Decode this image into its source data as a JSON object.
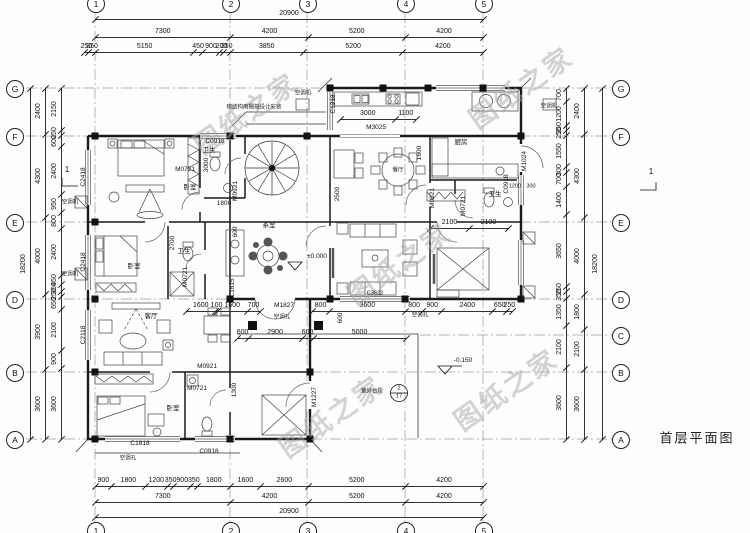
{
  "sheet": {
    "title": "首层平面图",
    "watermark": "图纸之家"
  },
  "grid": {
    "top": [
      "1",
      "2",
      "3",
      "4",
      "5"
    ],
    "bottom": [
      "1",
      "2",
      "3",
      "4",
      "5"
    ],
    "left": [
      "G",
      "F",
      "E",
      "D",
      "B",
      "A"
    ],
    "right": [
      "G",
      "F",
      "E",
      "D",
      "C",
      "B",
      "A"
    ]
  },
  "dims": {
    "top_total": [
      "20900"
    ],
    "top_major": [
      "7300",
      "4200",
      "5200",
      "4200"
    ],
    "top_minor": [
      "250",
      "350",
      "5150",
      "450",
      "900",
      "200",
      "350",
      "3850",
      "5200",
      "4200"
    ],
    "bottom_minor": [
      "900",
      "1800",
      "1200",
      "350",
      "900",
      "350",
      "1800",
      "1600",
      "2600",
      "5200",
      "4200"
    ],
    "bottom_major": [
      "7300",
      "4200",
      "5200",
      "4200"
    ],
    "bottom_total": [
      "20900"
    ],
    "left_outer": [
      "18200"
    ],
    "left_major": [
      "2400",
      "4300",
      "4000",
      "3900",
      "3600"
    ],
    "left_minor": [
      "2150",
      "250",
      "600",
      "2400",
      "950",
      "800",
      "2400",
      "450",
      "350",
      "250",
      "650",
      "2100",
      "900",
      "3600"
    ],
    "right_inner": [
      "700",
      "1200",
      "250",
      "250",
      "1550",
      "300",
      "700",
      "1400",
      "3650",
      "250",
      "350",
      "1350",
      "2100",
      "3600"
    ],
    "right_major": [
      "2400",
      "4300",
      "4000",
      "1800",
      "2100",
      "3600"
    ],
    "right_outer": [
      "18200"
    ],
    "kitchen_opening": [
      "3000",
      "1100"
    ],
    "bed4_top": [
      "2100",
      "2100"
    ],
    "entry_row": [
      "1600",
      "100",
      "1600",
      "700"
    ],
    "south_row": [
      "800",
      "3600",
      "800",
      "900",
      "2400",
      "650",
      "250"
    ],
    "porch": [
      "600",
      "2900",
      "600",
      "5000"
    ]
  },
  "rooms": {
    "bedroom": "卧室",
    "bath": "卫生",
    "kitchen": "厨房",
    "dining": "餐厅",
    "living": "客厅",
    "tea": "茶室"
  },
  "codes": {
    "c2418": "C2418",
    "c2118": "C2118",
    "c1818": "C1818",
    "c1218": "C1218",
    "c0918": "C0918",
    "c1615": "C1615",
    "c3622": "C3622",
    "m0721": "M0721",
    "m0921": "M0921",
    "m1024": "M1024",
    "m1227": "M1227",
    "m1827": "M1827",
    "m3025": "M3025"
  },
  "levels": {
    "zero": "±0.000",
    "minus": "-0.150",
    "steps": "室外台阶",
    "detail_no": "2",
    "detail_sheet": "17",
    "section": "1"
  },
  "notes": {
    "canopy": "钢结构雨棚按设计安装",
    "ac_unit": "空调机",
    "ac_hole": "空调孔"
  },
  "inline": {
    "d3000": "3000",
    "d1800": "1800",
    "d2700": "2700",
    "d2500": "2500",
    "d1600": "1600",
    "d1300": "1300",
    "d1200": "1200",
    "d300": "300",
    "d600": "600"
  }
}
